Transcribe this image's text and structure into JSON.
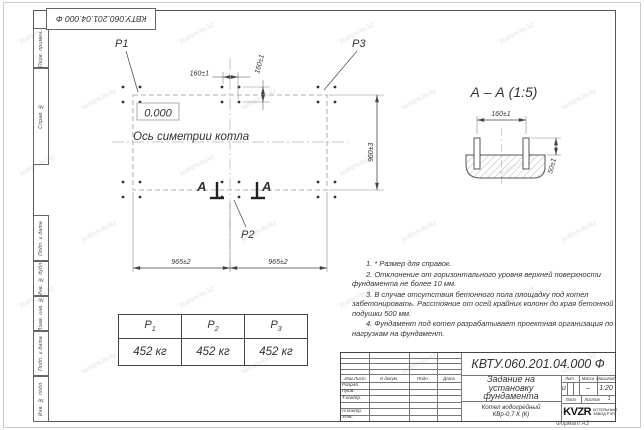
{
  "watermark": {
    "text": "kotlam-kv.kz"
  },
  "stamp_top": {
    "text": "КВТУ.060.201.04.000 Ф"
  },
  "margin": {
    "labels": [
      "Перв. примен.",
      "Справ. №",
      "Подп. и дата",
      "Инв. № дубл.",
      "Взам. инв. №",
      "Подп. и дата",
      "Инв. № подл."
    ]
  },
  "plan": {
    "p1": "P1",
    "p2": "P2",
    "p3": "P3",
    "level": "0.000",
    "axis_label": "Ось симетрии котла",
    "dim_top_h": "160±1",
    "dim_top_v": "160±1",
    "dim_right": "960±3",
    "dim_bottom_left": "965±2",
    "dim_bottom_right": "965±2",
    "section_letter_left": "А",
    "section_letter_right": "А"
  },
  "section_view": {
    "title": "А – А (1:5)",
    "dim_width": "160±1",
    "dim_height": "50±1"
  },
  "notes": [
    "1. * Размер для справок.",
    "2. Отклонение от горизонтального уровня верхней поверхности фундамента не более 10 мм.",
    "3. В случае отсутствия бетонного пола площадку под котел забетонировать. Расстояние от осей крайних колонн до края бетонной подушки 500 мм.",
    "4. Фундамент под котел разрабатывает проектная организация по нагрузкам на фундамент."
  ],
  "load_table": {
    "headers": [
      {
        "base": "P",
        "sub": "1"
      },
      {
        "base": "P",
        "sub": "2"
      },
      {
        "base": "P",
        "sub": "3"
      }
    ],
    "values": [
      "452 кг",
      "452 кг",
      "452 кг"
    ]
  },
  "title_block": {
    "doc_number": "КВТУ.060.201.04.000 Ф",
    "title_line1": "Задание на",
    "title_line2": "установку",
    "title_line3": "фундамента",
    "product_line1": "Котел водогрейный",
    "product_line2": "КВр-0,7 К (К)",
    "col_izm": "Изм.Лист",
    "col_doc": "N докум.",
    "col_sign": "Подп.",
    "col_date": "Дата",
    "row_labels": [
      "Разраб.",
      "Пров.",
      "Т.контр.",
      "",
      "Н.контр.",
      "Утв."
    ],
    "lit_label": "Лит.",
    "mass_label": "Масса",
    "scale_label": "Масштаб",
    "lit_value": "и",
    "mass_value": "–",
    "scale_value": "1:20",
    "sheet_label": "Лист",
    "sheets_label": "Листов",
    "sheets_value": "1",
    "logo_text": "KVZR",
    "logo_sub1": "КОТЕЛЬНЫЙ",
    "logo_sub2": "ЗАВОД РЭП",
    "format_label": "Формат А3"
  }
}
